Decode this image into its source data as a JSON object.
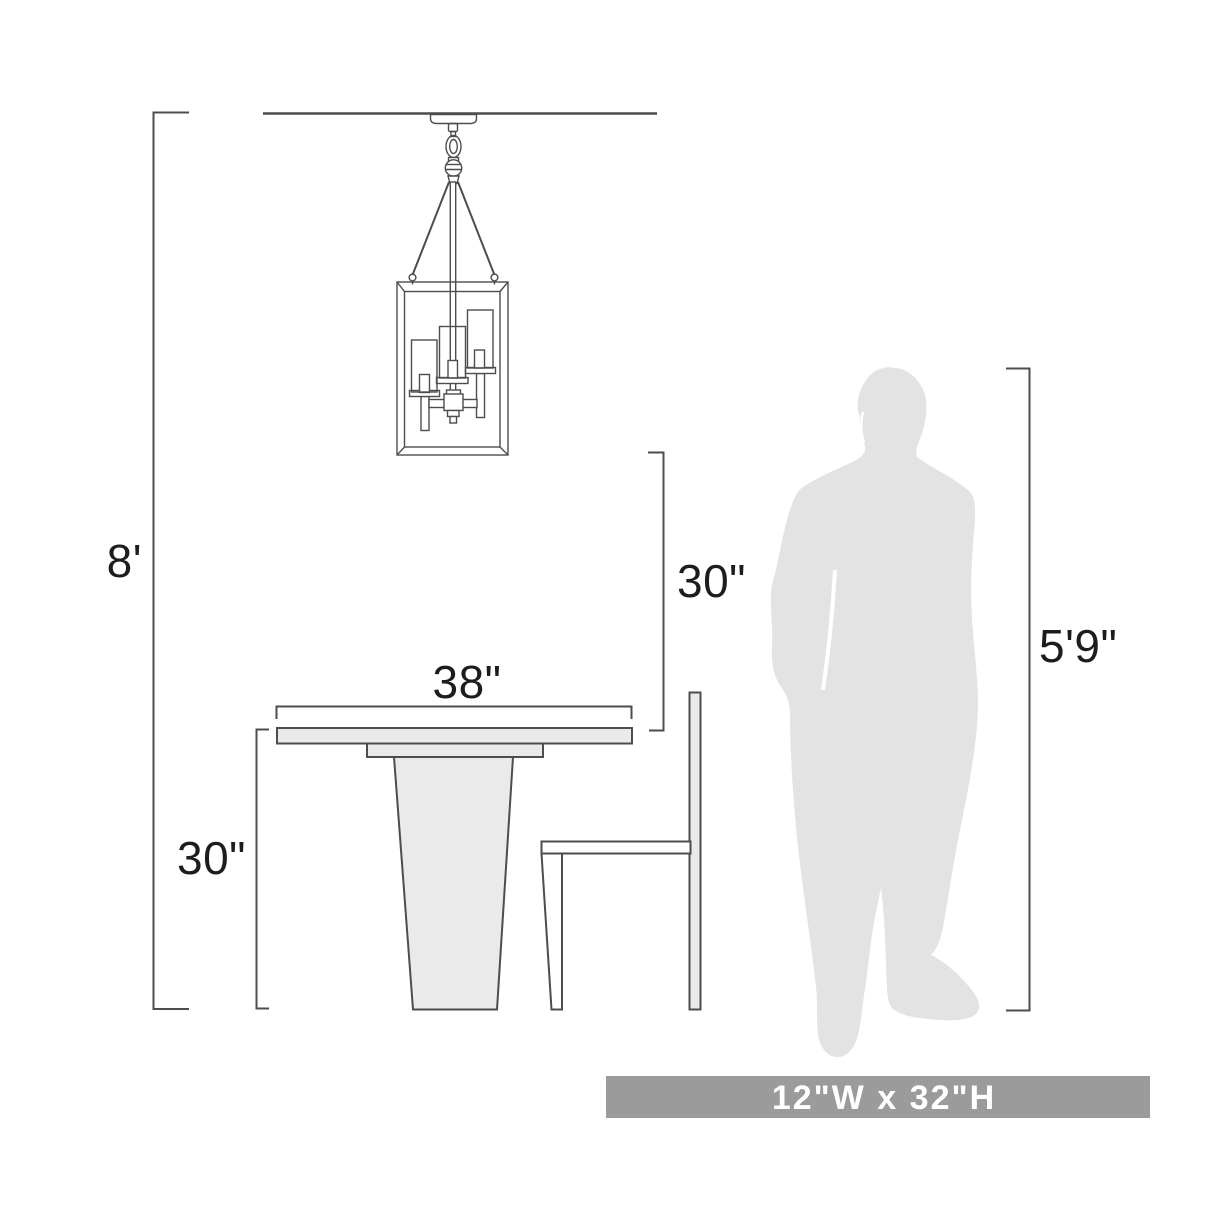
{
  "colors": {
    "background": "#ffffff",
    "line": "#4d4d4d",
    "object_fill": "#eaeaea",
    "silhouette": "#e3e3e3",
    "banner_bg": "#9b9b9b",
    "banner_text": "#ffffff",
    "label_text": "#1d1d1d"
  },
  "dimensions": {
    "ceiling_height": {
      "label": "8'"
    },
    "table_height": {
      "label": "30\""
    },
    "fixture_clearance": {
      "label": "30\""
    },
    "table_width": {
      "label": "38\""
    },
    "person_height": {
      "label": "5'9\""
    }
  },
  "banner": {
    "label": "12\"W x 32\"H"
  }
}
